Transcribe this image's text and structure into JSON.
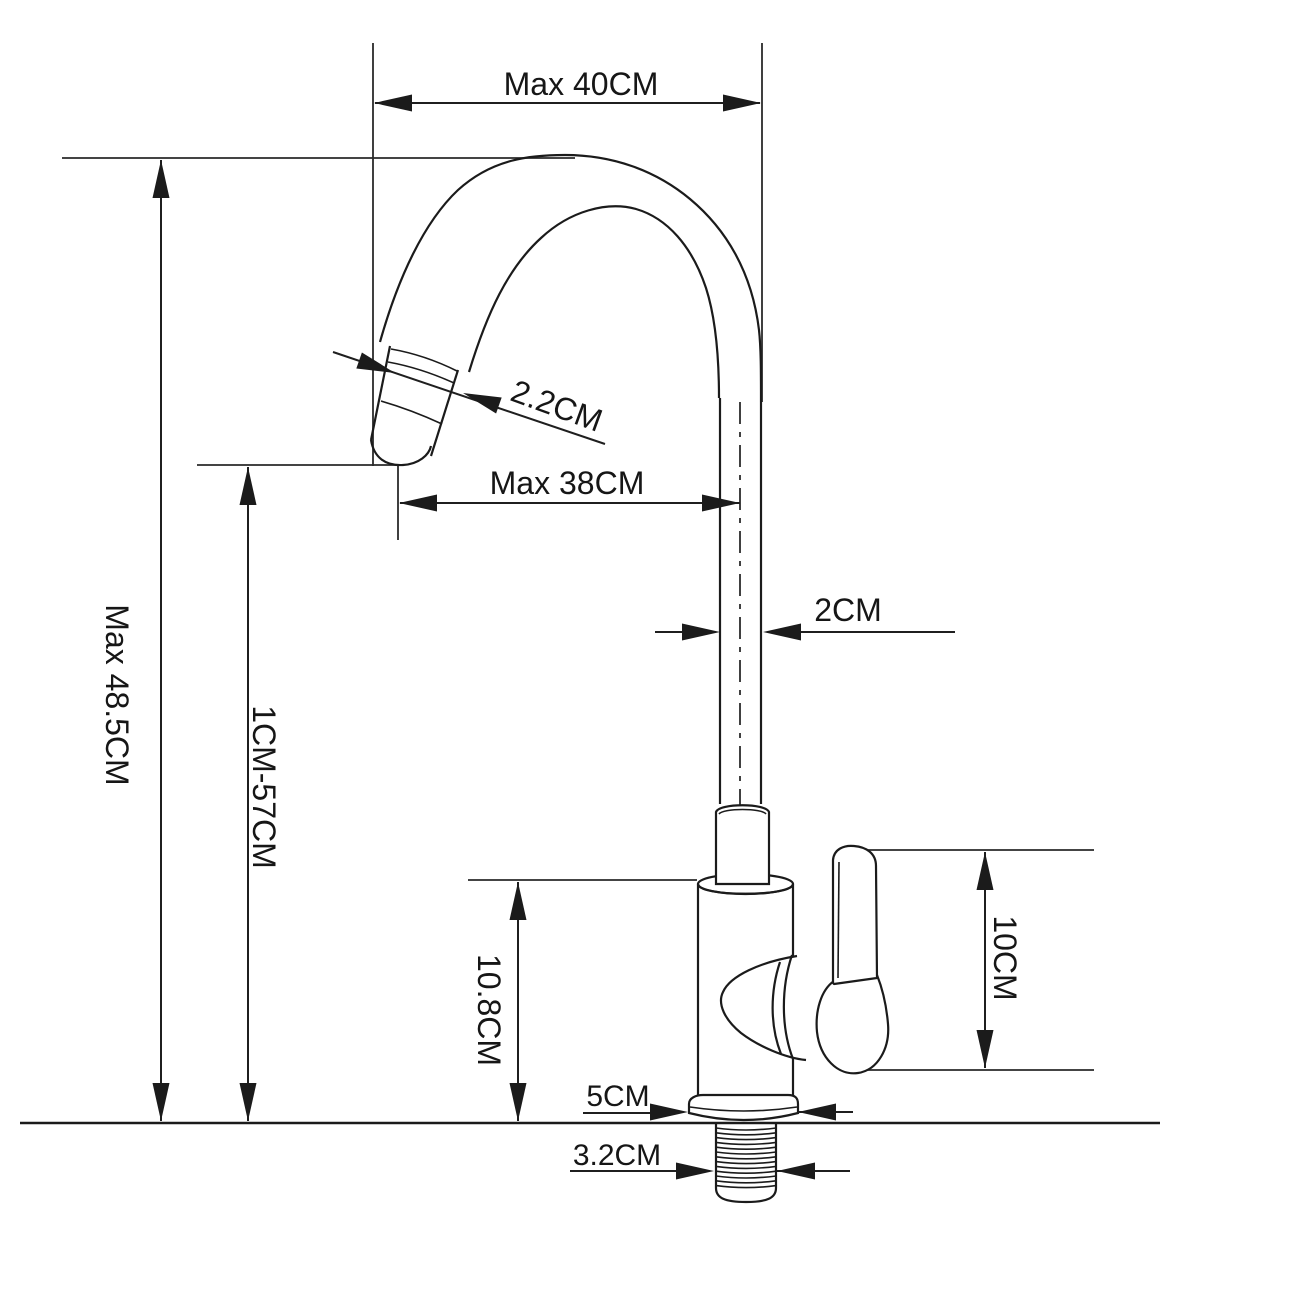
{
  "dimensions": {
    "spout_width": "Max 40CM",
    "overall_height": "Max 48.5CM",
    "spout_height_range": "1CM-57CM",
    "spout_tip_diameter": "2.2CM",
    "spout_reach": "Max 38CM",
    "pipe_diameter": "2CM",
    "body_height": "10.8CM",
    "handle_height": "10CM",
    "base_diameter": "5CM",
    "thread_diameter": "3.2CM"
  },
  "colors": {
    "line": "#1b1b1b",
    "background": "#ffffff"
  }
}
